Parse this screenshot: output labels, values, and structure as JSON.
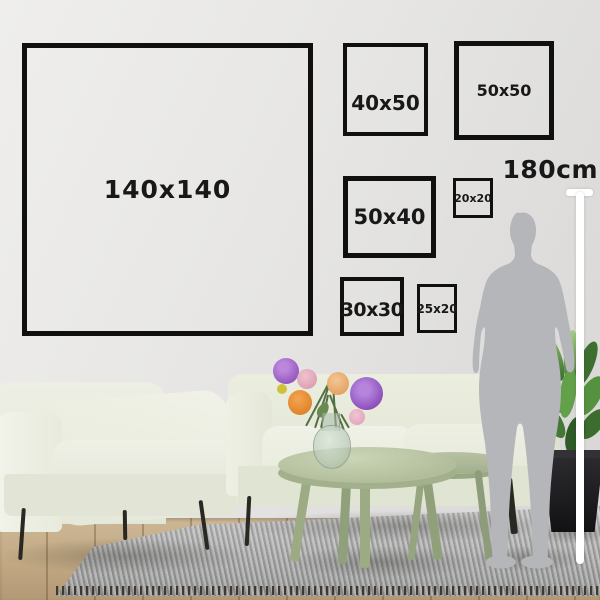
{
  "frames": [
    {
      "label": "140x140"
    },
    {
      "label": "40x50"
    },
    {
      "label": "50x50"
    },
    {
      "label": "50x40"
    },
    {
      "label": "20x20"
    },
    {
      "label": "30x30"
    },
    {
      "label": "25x20"
    }
  ],
  "height_marker": {
    "label": "180cm"
  },
  "colors": {
    "frame_border": "#101010",
    "label_text": "#181818",
    "ruler": "#ffffff",
    "silhouette": "#b5b6b9",
    "wall": "#e7e6e4",
    "sofa_cream": "#ecefe2",
    "table_sage": "#b3bfa0",
    "rug_gray": "#a8a8a8",
    "floor_wood": "#c2a983",
    "flower_purple": "#a06cd0",
    "flower_orange": "#ea9440",
    "flower_pink": "#e3aebd",
    "plant_green": "#4c7b3c",
    "pot_black": "#1f1f22"
  },
  "scene_objects": [
    "armchair",
    "sofa",
    "coffee-table-large",
    "coffee-table-small",
    "glass-vase",
    "flower-bouquet",
    "potted-plant",
    "area-rug",
    "wood-floor",
    "person-silhouette",
    "height-ruler"
  ]
}
